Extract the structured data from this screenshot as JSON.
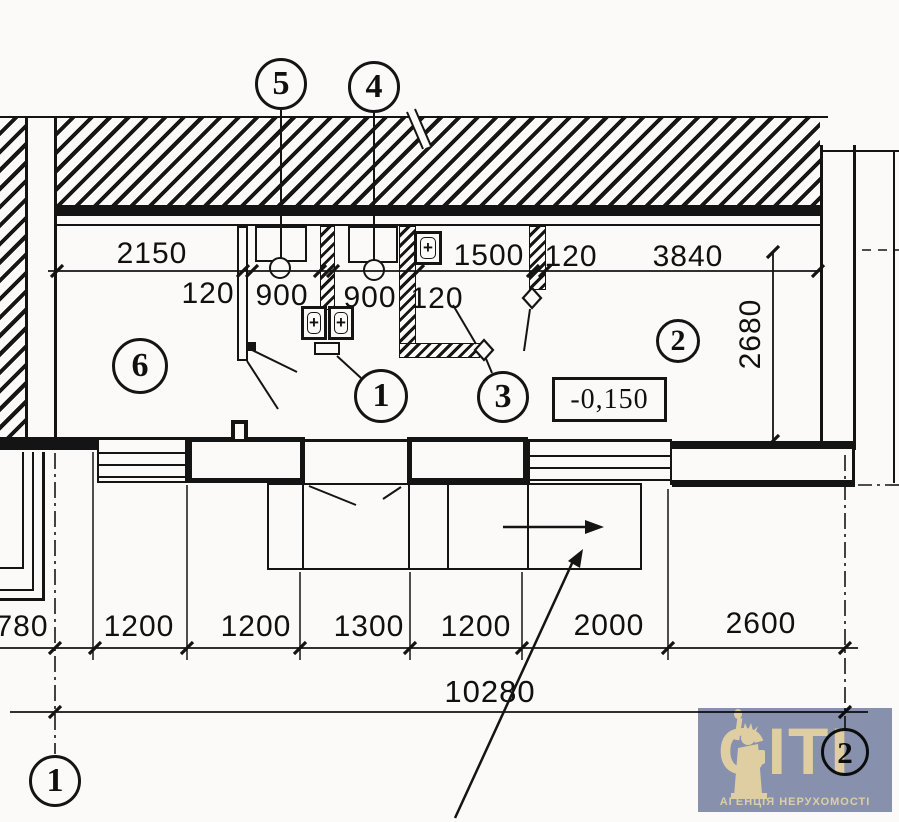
{
  "plan": {
    "position_markers": {
      "p5": "5",
      "p4": "4",
      "p6": "6",
      "p1": "1",
      "p3": "3",
      "p2": "2"
    },
    "axis_markers": {
      "a1": "1",
      "a2": "2"
    },
    "elevation_label": "-0,150",
    "fixture_plus": "+",
    "dims": {
      "top": {
        "w2150": "2150",
        "t120a": "120",
        "w900a": "900",
        "w900b": "900",
        "t120b": "120",
        "w1500": "1500",
        "t120c": "120",
        "w3840": "3840"
      },
      "right": {
        "h2680": "2680"
      },
      "bottom": {
        "w780": "780",
        "w1200a": "1200",
        "w1200b": "1200",
        "w1300": "1300",
        "w1200c": "1200",
        "w2000": "2000",
        "w2600": "2600"
      },
      "total": {
        "w10280": "10280"
      }
    },
    "colors": {
      "ink": "#141414",
      "paper": "#fbfaf8"
    }
  },
  "watermark": {
    "logo_text": "CITI",
    "caption": "АГЕНЦІЯ НЕРУХОМОСТІ",
    "bg_color": "#8994b2",
    "fg_color": "#e3d2a6"
  }
}
